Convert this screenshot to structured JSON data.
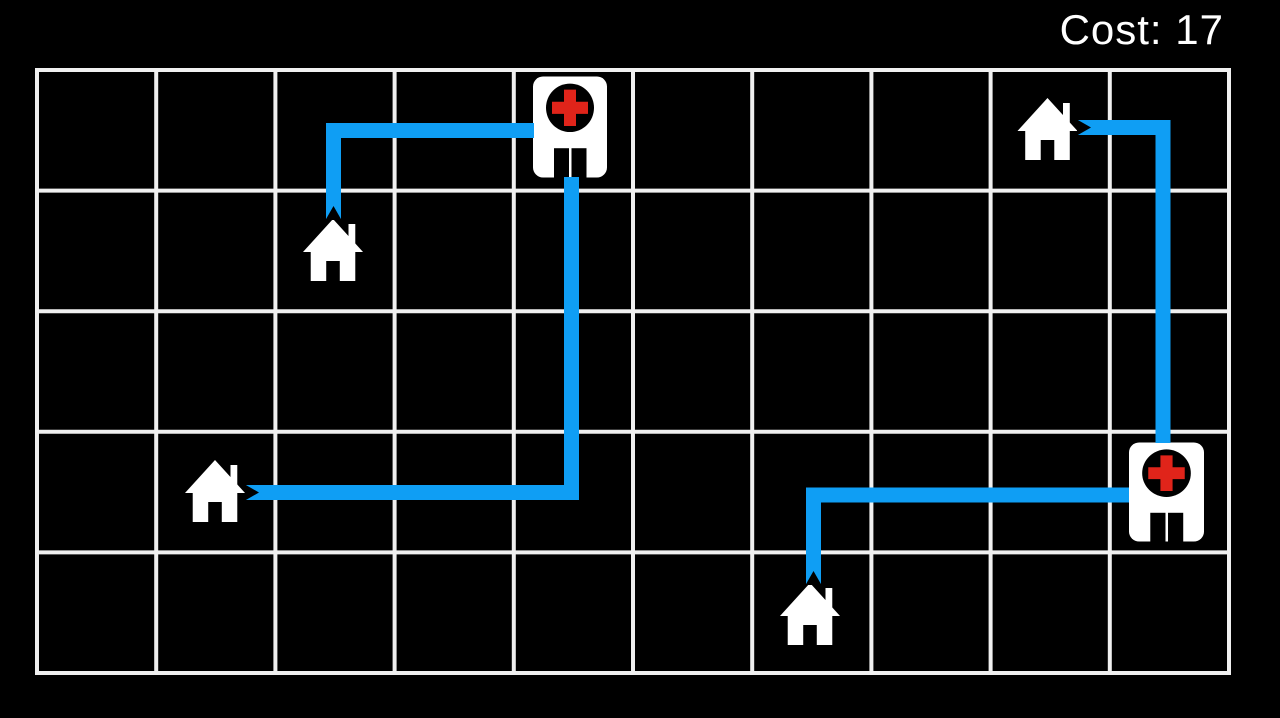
{
  "hud": {
    "cost_label": "Cost: 17",
    "cost_value": 17
  },
  "colors": {
    "background": "#000000",
    "grid_line": "#f0f0f0",
    "route": "#0f9ef4",
    "building_fill": "#ffffff",
    "cross_red": "#e0241a",
    "icon_dark": "#000000",
    "text": "#ffffff"
  },
  "grid": {
    "columns": 10,
    "rows": 5,
    "x_start": 37,
    "y_start": 70,
    "cell_width": 119.2,
    "cell_height": 120.6,
    "line_width": 4
  },
  "route_style": {
    "width": 15,
    "notch_depth": 14
  },
  "buildings": [
    {
      "type": "hospital",
      "name": "hospital-top",
      "row": 0,
      "col": 4,
      "x": 533,
      "y": 76.5,
      "w": 74,
      "h": 101
    },
    {
      "type": "hospital",
      "name": "hospital-right",
      "row": 3,
      "col": 9,
      "x": 1129,
      "y": 442.5,
      "w": 75,
      "h": 99
    },
    {
      "type": "house",
      "name": "house-upper-left",
      "row": 1,
      "col": 2,
      "x": 302,
      "y": 218,
      "w": 62,
      "h": 64
    },
    {
      "type": "house",
      "name": "house-mid-left",
      "row": 3,
      "col": 1,
      "x": 184,
      "y": 459,
      "w": 62,
      "h": 64
    },
    {
      "type": "house",
      "name": "house-bottom",
      "row": 4,
      "col": 6,
      "x": 779,
      "y": 582,
      "w": 62,
      "h": 64
    },
    {
      "type": "house",
      "name": "house-top-right",
      "row": 0,
      "col": 8,
      "x": 1016.5,
      "y": 97,
      "w": 62,
      "h": 64
    }
  ],
  "paths": [
    {
      "name": "route-hospital-top-to-house-upper-left",
      "from": "hospital-top",
      "to": "house-upper-left",
      "points": [
        [
          534,
          130.5
        ],
        [
          333.5,
          130.5
        ],
        [
          333.5,
          220
        ]
      ],
      "notch_at": "end"
    },
    {
      "name": "route-hospital-top-to-house-mid-left",
      "from": "hospital-top",
      "to": "house-mid-left",
      "points": [
        [
          571.5,
          177
        ],
        [
          571.5,
          492.5
        ],
        [
          245,
          492.5
        ]
      ],
      "notch_at": "end"
    },
    {
      "name": "route-house-top-right-to-hospital-right",
      "from": "house-top-right",
      "to": "hospital-right",
      "points": [
        [
          1077,
          127.5
        ],
        [
          1163,
          127.5
        ],
        [
          1163,
          443
        ]
      ],
      "notch_at": "start"
    },
    {
      "name": "route-hospital-right-to-house-bottom",
      "from": "hospital-right",
      "to": "house-bottom",
      "points": [
        [
          1129,
          495
        ],
        [
          813.5,
          495
        ],
        [
          813.5,
          585
        ]
      ],
      "notch_at": "end"
    }
  ]
}
